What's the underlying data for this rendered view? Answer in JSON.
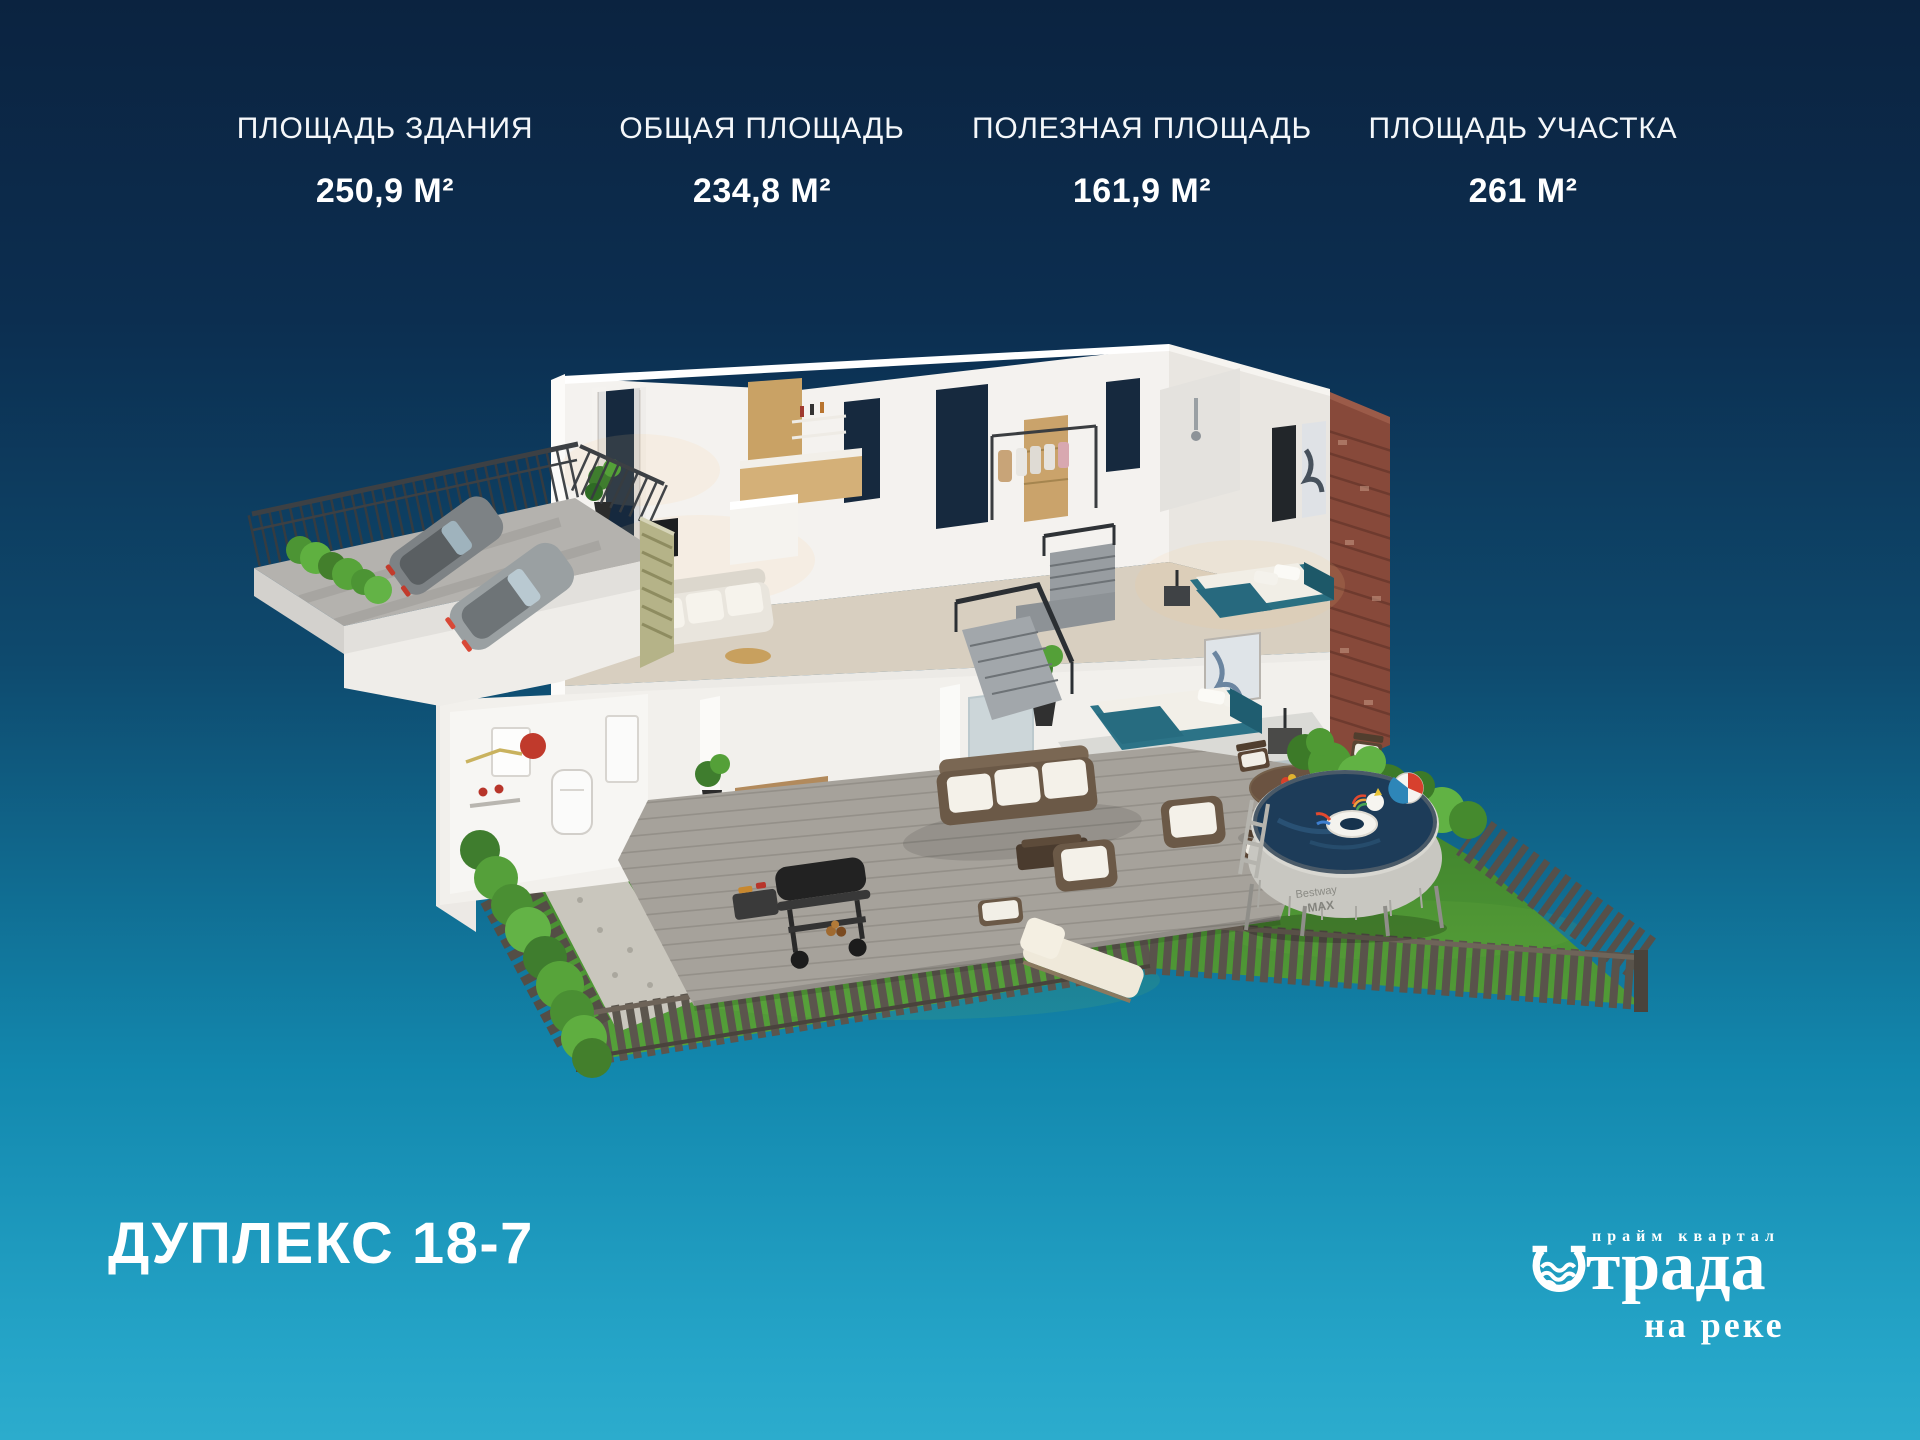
{
  "stats": [
    {
      "label": "ПЛОЩАДЬ ЗДАНИЯ",
      "value": "250,9 М²"
    },
    {
      "label": "ОБЩАЯ ПЛОЩАДЬ",
      "value": "234,8 М²"
    },
    {
      "label": "ПОЛЕЗНАЯ ПЛОЩАДЬ",
      "value": "161,9 М²"
    },
    {
      "label": "ПЛОЩАДЬ УЧАСТКА",
      "value": "261 М²"
    }
  ],
  "title": "ДУПЛЕКС 18-7",
  "logo": {
    "tagline": "прайм квартал",
    "name_full": "Отрада",
    "name_rest": "трада",
    "subtitle": "на реке"
  },
  "scene": {
    "pool_brand_line1": "Bestway",
    "pool_brand_line2": "MAX"
  },
  "colors": {
    "background_top": "#0b2340",
    "background_bottom": "#2caccd",
    "accent_teal": "#2a7082",
    "brick": "#87493a",
    "grass": "#4c9238",
    "text": "#ffffff"
  }
}
